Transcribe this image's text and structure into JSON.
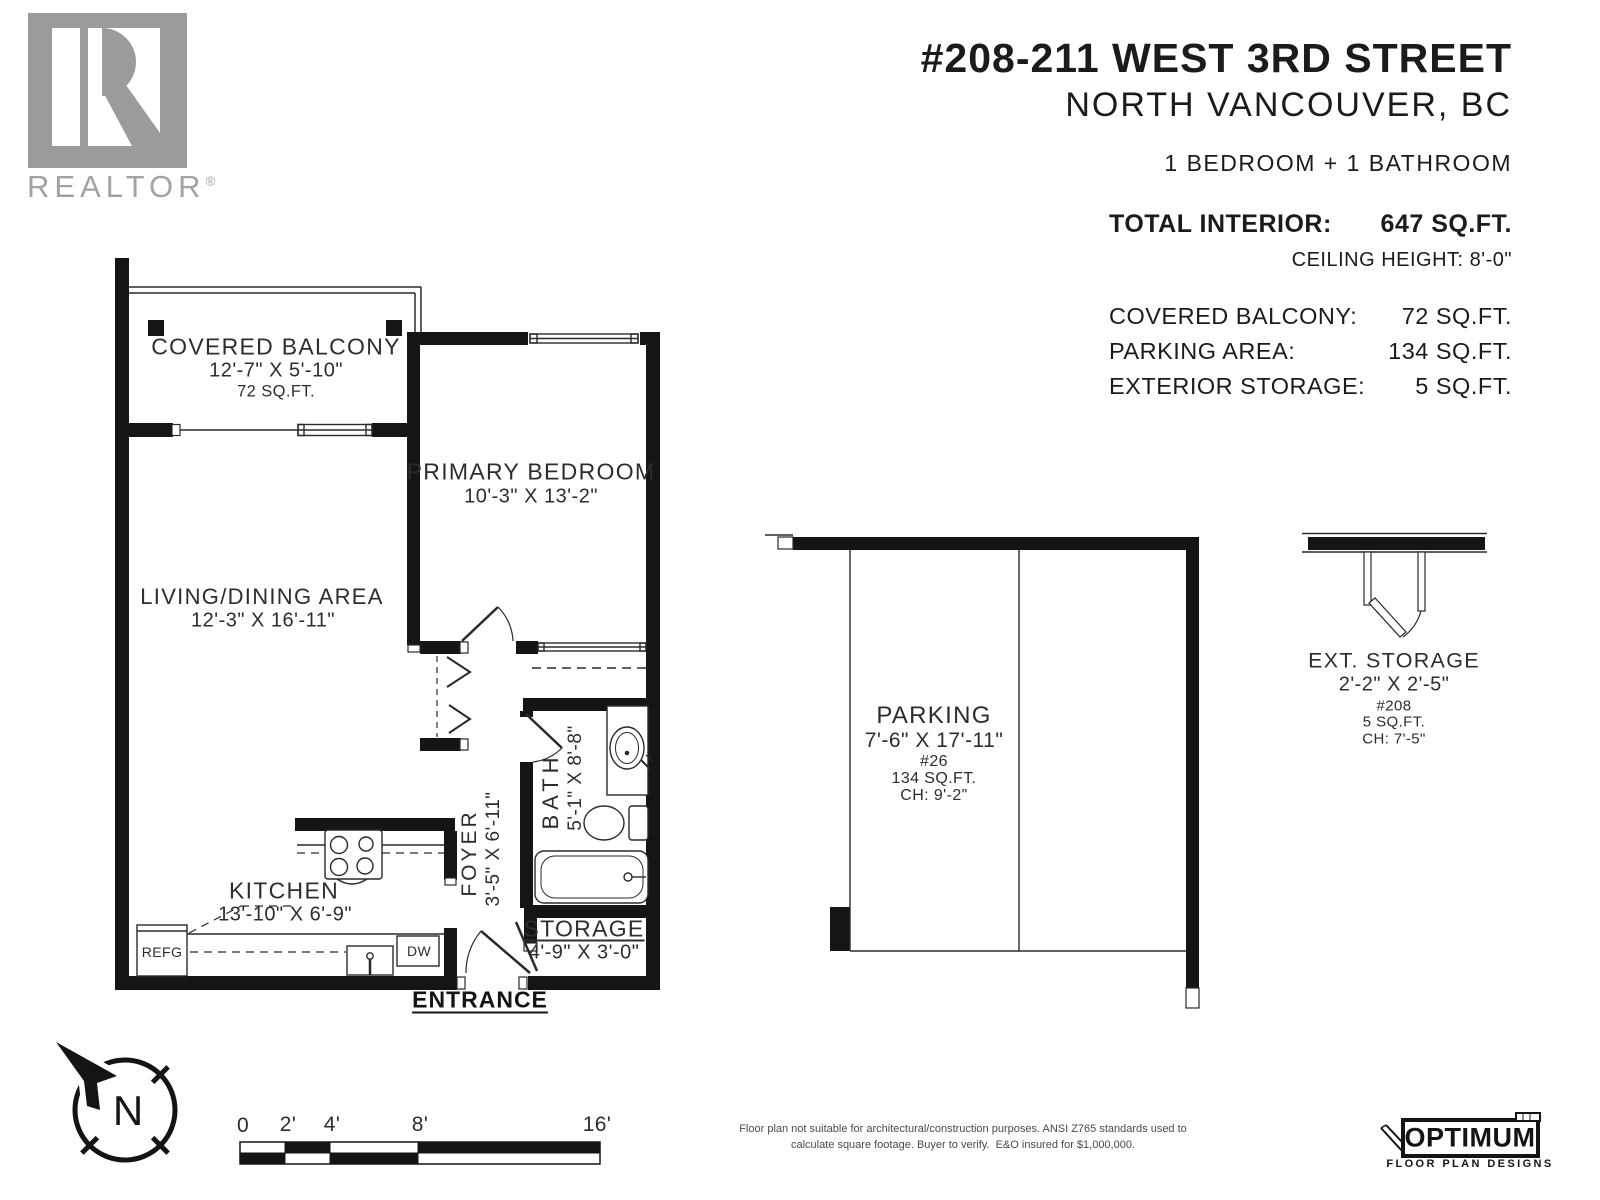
{
  "branding": {
    "realtor_logo_text": "REALTOR",
    "realtor_reg": "®"
  },
  "header": {
    "title": "#208-211 WEST 3RD STREET",
    "subtitle": "NORTH VANCOUVER, BC",
    "bed_bath": "1 BEDROOM + 1 BATHROOM",
    "total_interior_label": "TOTAL INTERIOR:",
    "total_interior_value": "647 SQ.FT.",
    "ceiling_height": "CEILING HEIGHT: 8'-0\"",
    "stats": [
      {
        "label": "COVERED BALCONY:",
        "value": "72 SQ.FT."
      },
      {
        "label": "PARKING AREA:",
        "value": "134 SQ.FT."
      },
      {
        "label": "EXTERIOR STORAGE:",
        "value": "5 SQ.FT."
      }
    ]
  },
  "floorplan": {
    "rooms": {
      "balcony": {
        "name": "COVERED BALCONY",
        "dims": "12'-7\" X 5'-10\"",
        "area": "72 SQ.FT."
      },
      "bedroom": {
        "name": "PRIMARY BEDROOM",
        "dims": "10'-3\" X 13'-2\""
      },
      "living": {
        "name": "LIVING/DINING AREA",
        "dims": "12'-3\" X 16'-11\""
      },
      "kitchen": {
        "name": "KITCHEN",
        "dims": "13'-10\" X 6'-9\""
      },
      "foyer": {
        "name": "FOYER",
        "dims": "3'-5\" X 6'-11\""
      },
      "bath": {
        "name": "BATH",
        "dims": "5'-1\" X 8'-8\""
      },
      "storage": {
        "name": "STORAGE",
        "dims": "4'-9\" X 3'-0\""
      }
    },
    "labels": {
      "entrance": "ENTRANCE",
      "refg": "REFG",
      "dw": "DW"
    }
  },
  "parking": {
    "name": "PARKING",
    "dims": "7'-6\" X 17'-11\"",
    "stall": "#26",
    "area": "134 SQ.FT.",
    "ceiling": "CH: 9'-2\""
  },
  "ext_storage": {
    "name": "EXT. STORAGE",
    "dims": "2'-2\" X 2'-5\"",
    "unit": "#208",
    "area": "5 SQ.FT.",
    "ceiling": "CH: 7'-5\""
  },
  "compass": {
    "letter": "N"
  },
  "scale_bar": {
    "ticks": [
      "0",
      "2'",
      "4'",
      "8'",
      "16'"
    ]
  },
  "footer": {
    "disclaimer_line1": "Floor plan not suitable for architectural/construction purposes. ANSI Z765 standards used to",
    "disclaimer_line2": "calculate square footage. Buyer to verify.  E&O insured for $1,000,000.",
    "logo_title": "OPTIMUM",
    "logo_subtitle": "FLOOR PLAN DESIGNS"
  }
}
